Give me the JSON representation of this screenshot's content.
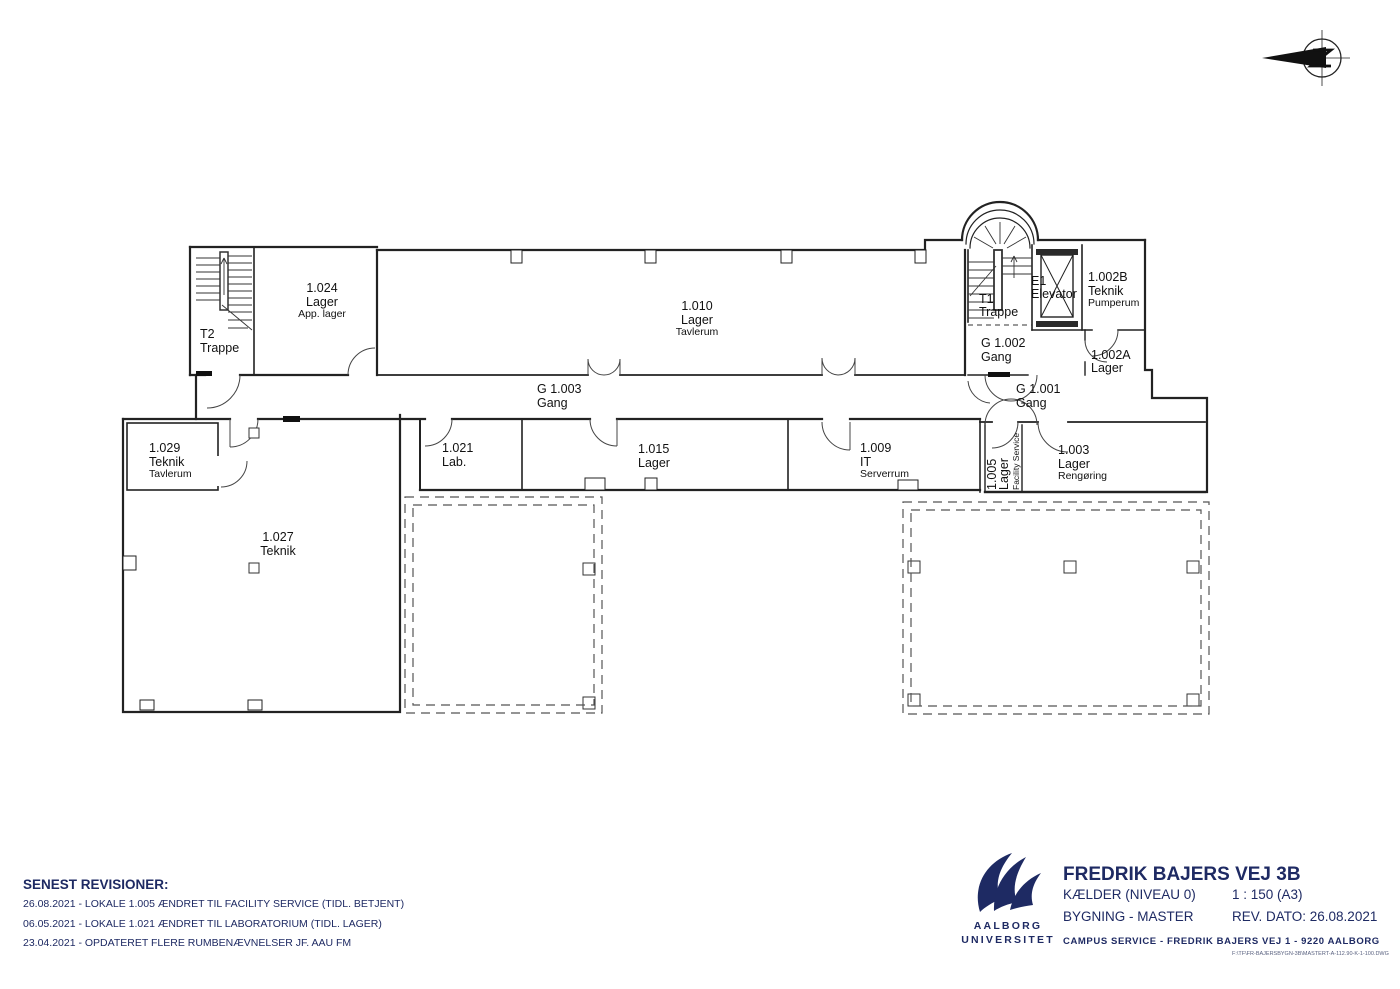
{
  "colors": {
    "ink": "#222222",
    "navy": "#1e2a63"
  },
  "plan": {
    "rooms": {
      "t2": {
        "id": "T2",
        "name": "Trappe"
      },
      "r1024": {
        "id": "1.024",
        "name": "Lager",
        "sub": "App. lager"
      },
      "r1010": {
        "id": "1.010",
        "name": "Lager",
        "sub": "Tavlerum"
      },
      "t1": {
        "id": "T1",
        "name": "Trappe"
      },
      "e1": {
        "id": "E1",
        "name": "Elevator"
      },
      "r1002b": {
        "id": "1.002B",
        "name": "Teknik",
        "sub": "Pumperum"
      },
      "g1002": {
        "id": "G 1.002",
        "name": "Gang"
      },
      "r1002a": {
        "id": "1.002A",
        "name": "Lager"
      },
      "g1003": {
        "id": "G 1.003",
        "name": "Gang"
      },
      "g1001": {
        "id": "G 1.001",
        "name": "Gang"
      },
      "r1029": {
        "id": "1.029",
        "name": "Teknik",
        "sub": "Tavlerum"
      },
      "r1027": {
        "id": "1.027",
        "name": "Teknik"
      },
      "r1021": {
        "id": "1.021",
        "name": "Lab."
      },
      "r1015": {
        "id": "1.015",
        "name": "Lager"
      },
      "r1009": {
        "id": "1.009",
        "name": "IT",
        "sub": "Serverrum"
      },
      "r1005": {
        "id": "1.005",
        "name": "Lager",
        "sub": "Facility Service"
      },
      "r1003": {
        "id": "1.003",
        "name": "Lager",
        "sub": "Rengøring"
      }
    }
  },
  "revisions": {
    "heading": "SENEST REVISIONER:",
    "items": [
      "26.08.2021 - LOKALE 1.005 ÆNDRET TIL FACILITY SERVICE (TIDL. BETJENT)",
      "06.05.2021 - LOKALE 1.021  ÆNDRET TIL LABORATORIUM (TIDL. LAGER)",
      "23.04.2021 - OPDATERET FLERE RUMBENÆVNELSER JF. AAU FM"
    ]
  },
  "title_block": {
    "title": "FREDRIK BAJERS VEJ 3B",
    "level": "KÆLDER (NIVEAU 0)",
    "scale": "1 : 150 (A3)",
    "building": "BYGNING - MASTER",
    "rev_date": "REV. DATO:  26.08.2021",
    "campus_line": "CAMPUS SERVICE   -   FREDRIK BAJERS VEJ 1   -   9220 AALBORG",
    "file_path": "F:\\TF\\FR-BAJERSBYGN-3B\\MASTERT-A-112.90-K-1-100.DWG"
  },
  "logo": {
    "line1": "AALBORG",
    "line2": "UNIVERSITET"
  }
}
